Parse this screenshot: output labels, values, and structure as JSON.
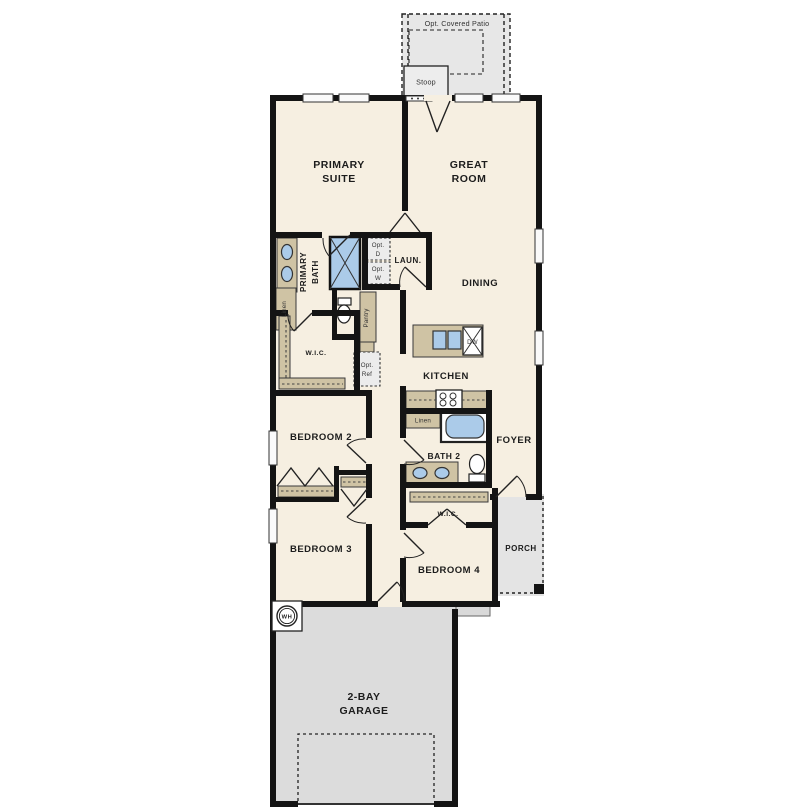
{
  "labels": {
    "patio": "Opt. Covered Patio",
    "stoop": "Stoop",
    "primary_suite_1": "PRIMARY",
    "primary_suite_2": "SUITE",
    "great_room_1": "GREAT",
    "great_room_2": "ROOM",
    "primary_bath_1": "PRIMARY",
    "primary_bath_2": "BATH",
    "laundry": "LAUN.",
    "opt_dryer_1": "Opt.",
    "opt_dryer_2": "D",
    "opt_washer_1": "Opt.",
    "opt_washer_2": "W",
    "dining": "DINING",
    "linen_primary": "Linen",
    "pantry": "Pantry",
    "wic_primary": "W.I.C.",
    "opt_ref_1": "Opt.",
    "opt_ref_2": "Ref",
    "kitchen": "KITCHEN",
    "dishwasher": "DW",
    "bedroom2": "BEDROOM 2",
    "linen_bath2": "Linen",
    "bath2": "BATH 2",
    "foyer": "FOYER",
    "wic_bed4": "W.I.C.",
    "porch": "PORCH",
    "bedroom3": "BEDROOM 3",
    "bedroom4": "BEDROOM 4",
    "garage_1": "2-BAY",
    "garage_2": "GARAGE",
    "water_heater": "WH"
  },
  "colors": {
    "wall": "#141414",
    "floor": "#f6efe1",
    "garage_floor": "#dcdcdc",
    "patio_floor": "#e7e7e7",
    "porch_floor": "#e4e4e4",
    "cabinet": "#cfc3a4",
    "fixture": "#abcbe9",
    "window": "#fafafa"
  }
}
